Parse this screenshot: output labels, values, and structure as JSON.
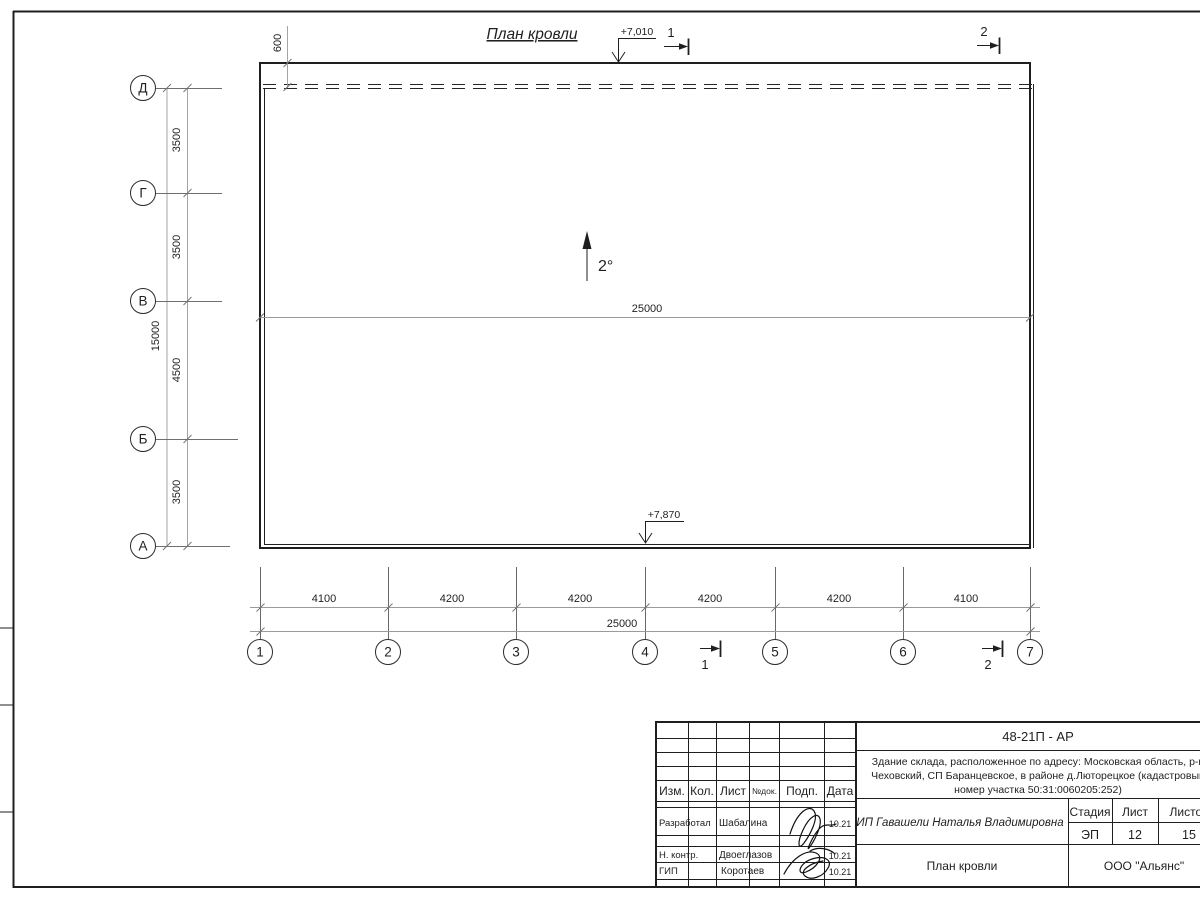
{
  "colors": {
    "ink": "#1f1f1f",
    "dim_line": "#9a9a9a"
  },
  "drawing": {
    "title": "План кровли",
    "slope_label": "2°",
    "elevation_top": "+7,010",
    "elevation_bottom": "+7,870",
    "overhang_dim": "600",
    "inner_width_dim": "25000",
    "section_mark_1": "1",
    "section_mark_2": "2"
  },
  "axes": {
    "left": {
      "labels": [
        "Д",
        "Г",
        "В",
        "Б",
        "А"
      ],
      "segment_dims": [
        "3500",
        "3500",
        "4500",
        "3500"
      ],
      "total_dim": "15000"
    },
    "bottom": {
      "labels": [
        "1",
        "2",
        "3",
        "4",
        "5",
        "6",
        "7"
      ],
      "segment_dims": [
        "4100",
        "4200",
        "4200",
        "4200",
        "4200",
        "4100"
      ],
      "total_dim": "25000"
    }
  },
  "title_block": {
    "code": "48-21П - АР",
    "description_lines": [
      "Здание склада, расположенное по адресу: Московская область, р-н",
      "Чеховский, СП Баранцевское, в районе д.Люторецкое  (кадастровый",
      "номер участка 50:31:0060205:252)"
    ],
    "client": "ИП Гавашели Наталья Владимировна",
    "sheet_title": "План кровли",
    "company": "ООО \"Альянс\"",
    "columns": [
      "Изм.",
      "Кол.",
      "Лист",
      "№док.",
      "Подп.",
      "Дата"
    ],
    "stage_header": "Стадия",
    "sheet_header": "Лист",
    "sheets_header": "Листов",
    "stage": "ЭП",
    "sheet_no": "12",
    "sheets_total": "15",
    "rows": [
      {
        "role": "Разработал",
        "name": "Шабалина",
        "date": "10.21"
      },
      {
        "role": "Н. контр.",
        "name": "Двоеглазов",
        "date": "10.21"
      },
      {
        "role": "ГИП",
        "name": "Коротаев",
        "date": "10.21"
      }
    ]
  }
}
